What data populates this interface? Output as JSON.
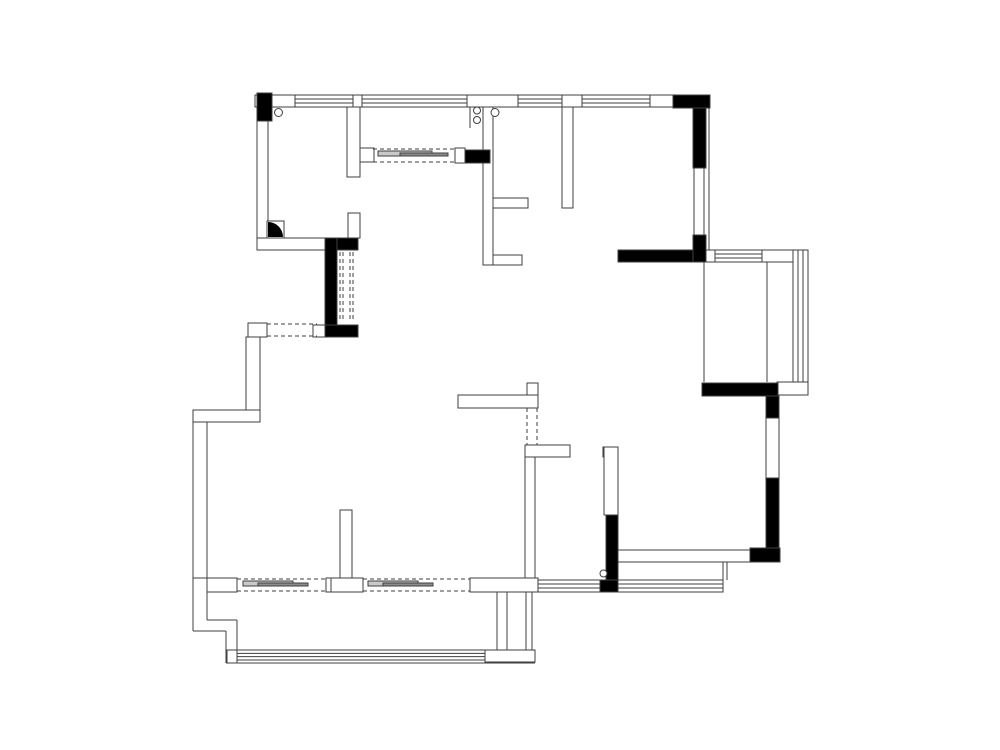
{
  "meta": {
    "canvas": {
      "width": 1000,
      "height": 750
    },
    "colors": {
      "background": "#ffffff",
      "line": "#3f3f3f",
      "solid_wall": "#000000",
      "slider_light": "#c9c9c9",
      "slider_dark": "#8c8c8c"
    }
  },
  "plan": {
    "wall_bands": [
      [
        255,
        95,
        455,
        12
      ],
      [
        257,
        107,
        11,
        141
      ],
      [
        257,
        238,
        71,
        12
      ],
      [
        347,
        107,
        13,
        70
      ],
      [
        348,
        213,
        12,
        25
      ],
      [
        360,
        148,
        14,
        14
      ],
      [
        455,
        148,
        10,
        15
      ],
      [
        483,
        107,
        10,
        158
      ],
      [
        493,
        198,
        35,
        10
      ],
      [
        493,
        255,
        29,
        10
      ],
      [
        562,
        107,
        11,
        101
      ],
      [
        248,
        323,
        19,
        14
      ],
      [
        313,
        325,
        12,
        12
      ],
      [
        246,
        337,
        14,
        74
      ],
      [
        193,
        410,
        67,
        12
      ],
      [
        193,
        422,
        14,
        156
      ],
      [
        207,
        578,
        30,
        14
      ],
      [
        470,
        578,
        68,
        14
      ],
      [
        330,
        578,
        33,
        14
      ],
      [
        340,
        510,
        12,
        68
      ],
      [
        326,
        578,
        5,
        14
      ],
      [
        458,
        395,
        80,
        13
      ],
      [
        527,
        383,
        11,
        12
      ],
      [
        525,
        445,
        45,
        12
      ],
      [
        525,
        457,
        10,
        121
      ],
      [
        603,
        447,
        8,
        10
      ],
      [
        604,
        447,
        14,
        68
      ],
      [
        618,
        550,
        132,
        12
      ],
      [
        694,
        168,
        10,
        67
      ],
      [
        766,
        418,
        13,
        60
      ],
      [
        777,
        382,
        31,
        13
      ],
      [
        705,
        250,
        10,
        12
      ],
      [
        762,
        250,
        46,
        12
      ],
      [
        227,
        650,
        10,
        13
      ],
      [
        485,
        650,
        50,
        12
      ],
      [
        497,
        592,
        10,
        58
      ],
      [
        526,
        592,
        6,
        58
      ]
    ],
    "solid_walls": [
      [
        257,
        93,
        15,
        28
      ],
      [
        673,
        95,
        37,
        13
      ],
      [
        693,
        108,
        13,
        60
      ],
      [
        693,
        235,
        13,
        27
      ],
      [
        618,
        250,
        75,
        12
      ],
      [
        328,
        238,
        30,
        12
      ],
      [
        325,
        238,
        12,
        99
      ],
      [
        325,
        325,
        33,
        12
      ],
      [
        465,
        150,
        25,
        13
      ],
      [
        702,
        383,
        76,
        13
      ],
      [
        766,
        396,
        13,
        22
      ],
      [
        766,
        478,
        13,
        82
      ],
      [
        750,
        548,
        30,
        14
      ],
      [
        606,
        515,
        12,
        67
      ],
      [
        600,
        580,
        18,
        12
      ]
    ],
    "windows_h": [
      [
        295,
        95,
        58,
        12
      ],
      [
        362,
        95,
        105,
        12
      ],
      [
        518,
        95,
        44,
        12
      ],
      [
        582,
        95,
        68,
        12
      ],
      [
        715,
        250,
        47,
        12
      ],
      [
        538,
        580,
        185,
        12
      ],
      [
        237,
        650,
        248,
        10
      ]
    ],
    "windows_v": [
      [
        793,
        250,
        15,
        132
      ]
    ],
    "lines": [
      [
        704,
        262,
        704,
        382
      ],
      [
        767,
        262,
        767,
        382
      ],
      [
        723,
        562,
        723,
        580
      ],
      [
        727,
        562,
        727,
        580
      ],
      [
        470,
        107,
        470,
        128
      ],
      [
        709,
        108,
        709,
        250
      ],
      [
        193,
        578,
        193,
        631
      ],
      [
        193,
        631,
        226,
        631
      ],
      [
        226,
        631,
        226,
        663
      ],
      [
        226,
        663,
        535,
        663
      ],
      [
        207,
        592,
        207,
        620
      ],
      [
        207,
        620,
        237,
        620
      ],
      [
        237,
        620,
        237,
        650
      ]
    ],
    "dashed_lines": [
      [
        267,
        324,
        317,
        324
      ],
      [
        267,
        336,
        317,
        336
      ],
      [
        340,
        252,
        340,
        322
      ],
      [
        343,
        252,
        343,
        322
      ],
      [
        350,
        252,
        350,
        322
      ],
      [
        353,
        252,
        353,
        322
      ],
      [
        373,
        149,
        455,
        149
      ],
      [
        373,
        162,
        455,
        162
      ],
      [
        527,
        408,
        527,
        445
      ],
      [
        537,
        408,
        537,
        445
      ],
      [
        237,
        579,
        328,
        579
      ],
      [
        237,
        591,
        328,
        591
      ],
      [
        363,
        579,
        470,
        579
      ],
      [
        363,
        591,
        470,
        591
      ]
    ],
    "slider_panels": [
      {
        "x": 378,
        "y": 151,
        "w": 54,
        "h": 5,
        "shade": "light"
      },
      {
        "x": 400,
        "y": 153,
        "w": 48,
        "h": 3,
        "shade": "dark"
      },
      {
        "x": 243,
        "y": 581,
        "w": 50,
        "h": 5,
        "shade": "light"
      },
      {
        "x": 258,
        "y": 583,
        "w": 50,
        "h": 3,
        "shade": "dark"
      },
      {
        "x": 368,
        "y": 581,
        "w": 50,
        "h": 5,
        "shade": "light"
      },
      {
        "x": 383,
        "y": 583,
        "w": 50,
        "h": 3,
        "shade": "dark"
      }
    ],
    "circles": [
      [
        278.5,
        112.5,
        4
      ],
      [
        477,
        110.5,
        3.5
      ],
      [
        477,
        120,
        3.5
      ],
      [
        495,
        112.5,
        4
      ],
      [
        603.5,
        573.5,
        3.5
      ]
    ],
    "corner_marker": {
      "x": 267,
      "y": 221,
      "size": 17
    }
  }
}
